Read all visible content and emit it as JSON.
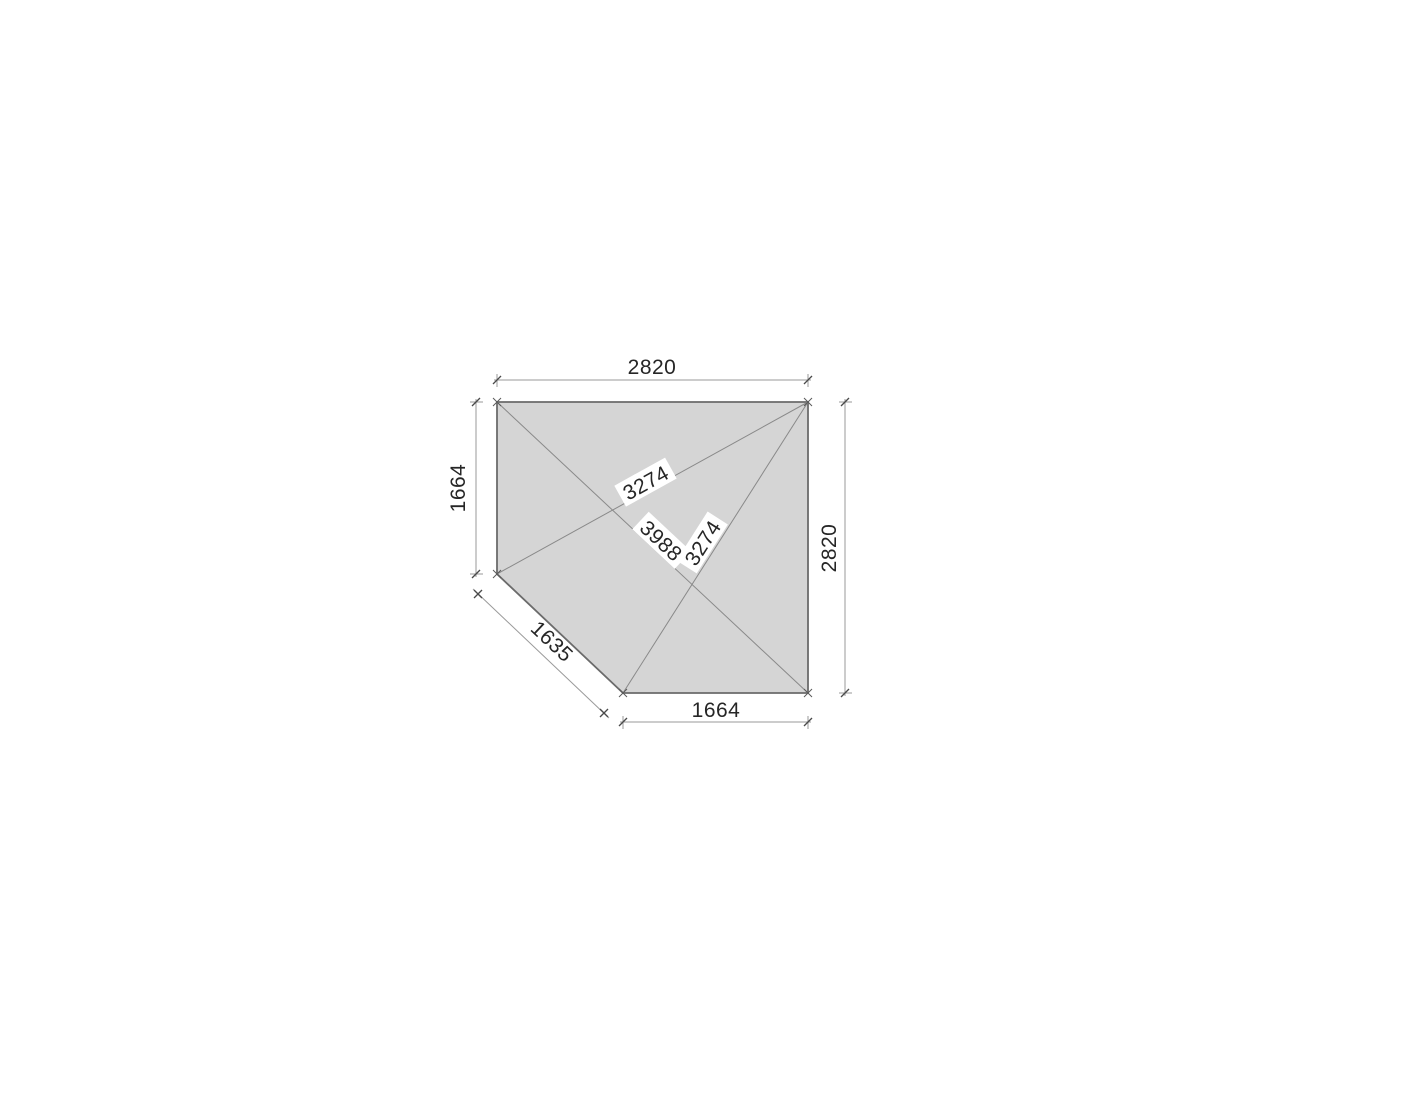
{
  "diagram": {
    "kind": "architectural-plan-drawing",
    "shape": "square-with-cut-bottom-left-corner",
    "colors": {
      "shape_fill": "#d5d5d5",
      "shape_outline": "#6b6b6b",
      "inner_lines": "#898989",
      "dimension_lines": "#9a9a9a",
      "text": "#262626",
      "background": "#ffffff"
    },
    "dimensions": {
      "top_width": "2820",
      "left_height": "1664",
      "right_height": "2820",
      "bottom_width": "1664",
      "cut_edge": "1635",
      "diag_left_to_topright": "3274",
      "diag_topleft_to_bottomright": "3988",
      "diag_bottom_to_topright": "3274"
    }
  }
}
